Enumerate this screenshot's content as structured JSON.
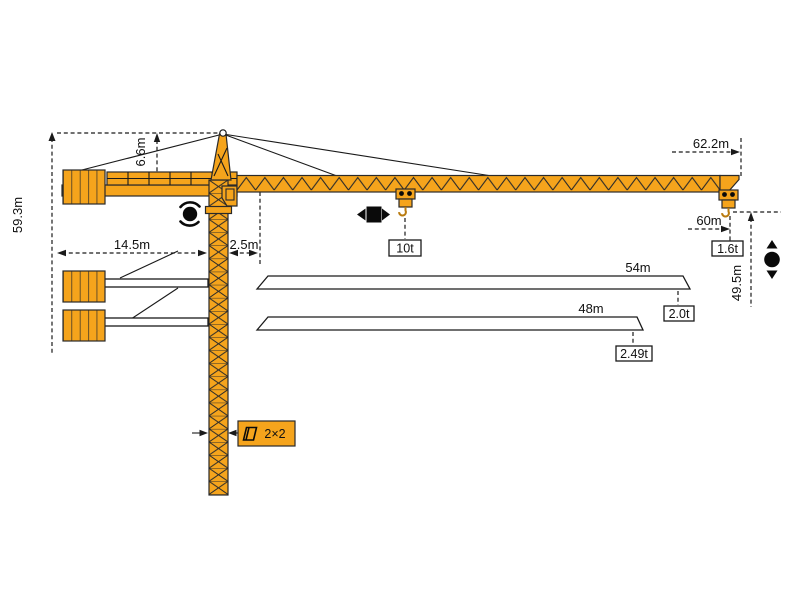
{
  "diagram": {
    "subject": "tower-crane-dimension-diagram",
    "colors": {
      "crane_orange": "#F5A41C",
      "line_black": "#1a1a1a",
      "background": "#ffffff"
    },
    "labels": {
      "total_height": "59.3m",
      "head_height": "6.6m",
      "counter_jib": "14.5m",
      "clearance": "2.5m",
      "jib_max": "62.2m",
      "radius_max": "60m",
      "hook_height": "49.5m",
      "cap_max": "10t",
      "cap_60": "1.6t",
      "jib_54": "54m",
      "cap_54": "2.0t",
      "jib_48": "48m",
      "cap_48": "2.49t",
      "mast": "2×2"
    },
    "icons": [
      "slewing-icon",
      "trolley-travel-icon",
      "hoist-icon",
      "mast-section-icon"
    ]
  }
}
